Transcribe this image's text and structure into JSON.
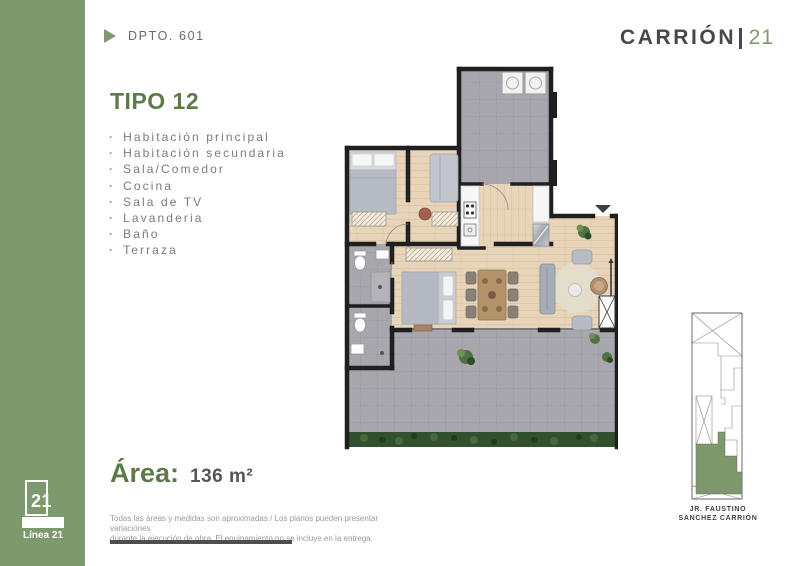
{
  "header": {
    "unit_label": "DPTO. 601",
    "brand": {
      "name": "CARRIÓN",
      "separator": "|",
      "number": "21"
    }
  },
  "unit": {
    "type_title": "TIPO 12",
    "features": [
      "Habitación principal",
      "Habitación secundaria",
      "Sala/Comedor",
      "Cocina",
      "Sala de TV",
      "Lavanderia",
      "Baño",
      "Terraza"
    ],
    "area_label": "Área:",
    "area_value": "136 m²"
  },
  "disclaimer": {
    "line1": "Todas las áreas y medidas son aproximadas / Los planos pueden presentar variaciones",
    "line2": "durante la ejecución de obra. El equipamiento no se incluye en la entrega."
  },
  "key_plan": {
    "street_line1": "JR. FAUSTINO",
    "street_line2": "SANCHEZ CARRIÓN"
  },
  "footer_logo": {
    "number": "21",
    "line": "Línea 21"
  },
  "icons": {
    "dpto_marker": "right-triangle",
    "entrance_marker": "down-triangle"
  },
  "theme": {
    "brand_green": "#7E996D",
    "heading_green": "#5E7A49",
    "dark_text": "#45494C",
    "list_gray": "#7B7B7B",
    "wood_floor": "#E7D4B9",
    "tile_gray": "#A7A7AD",
    "wall_dark": "#1F1F1F",
    "hedge_green": "#33502E"
  }
}
